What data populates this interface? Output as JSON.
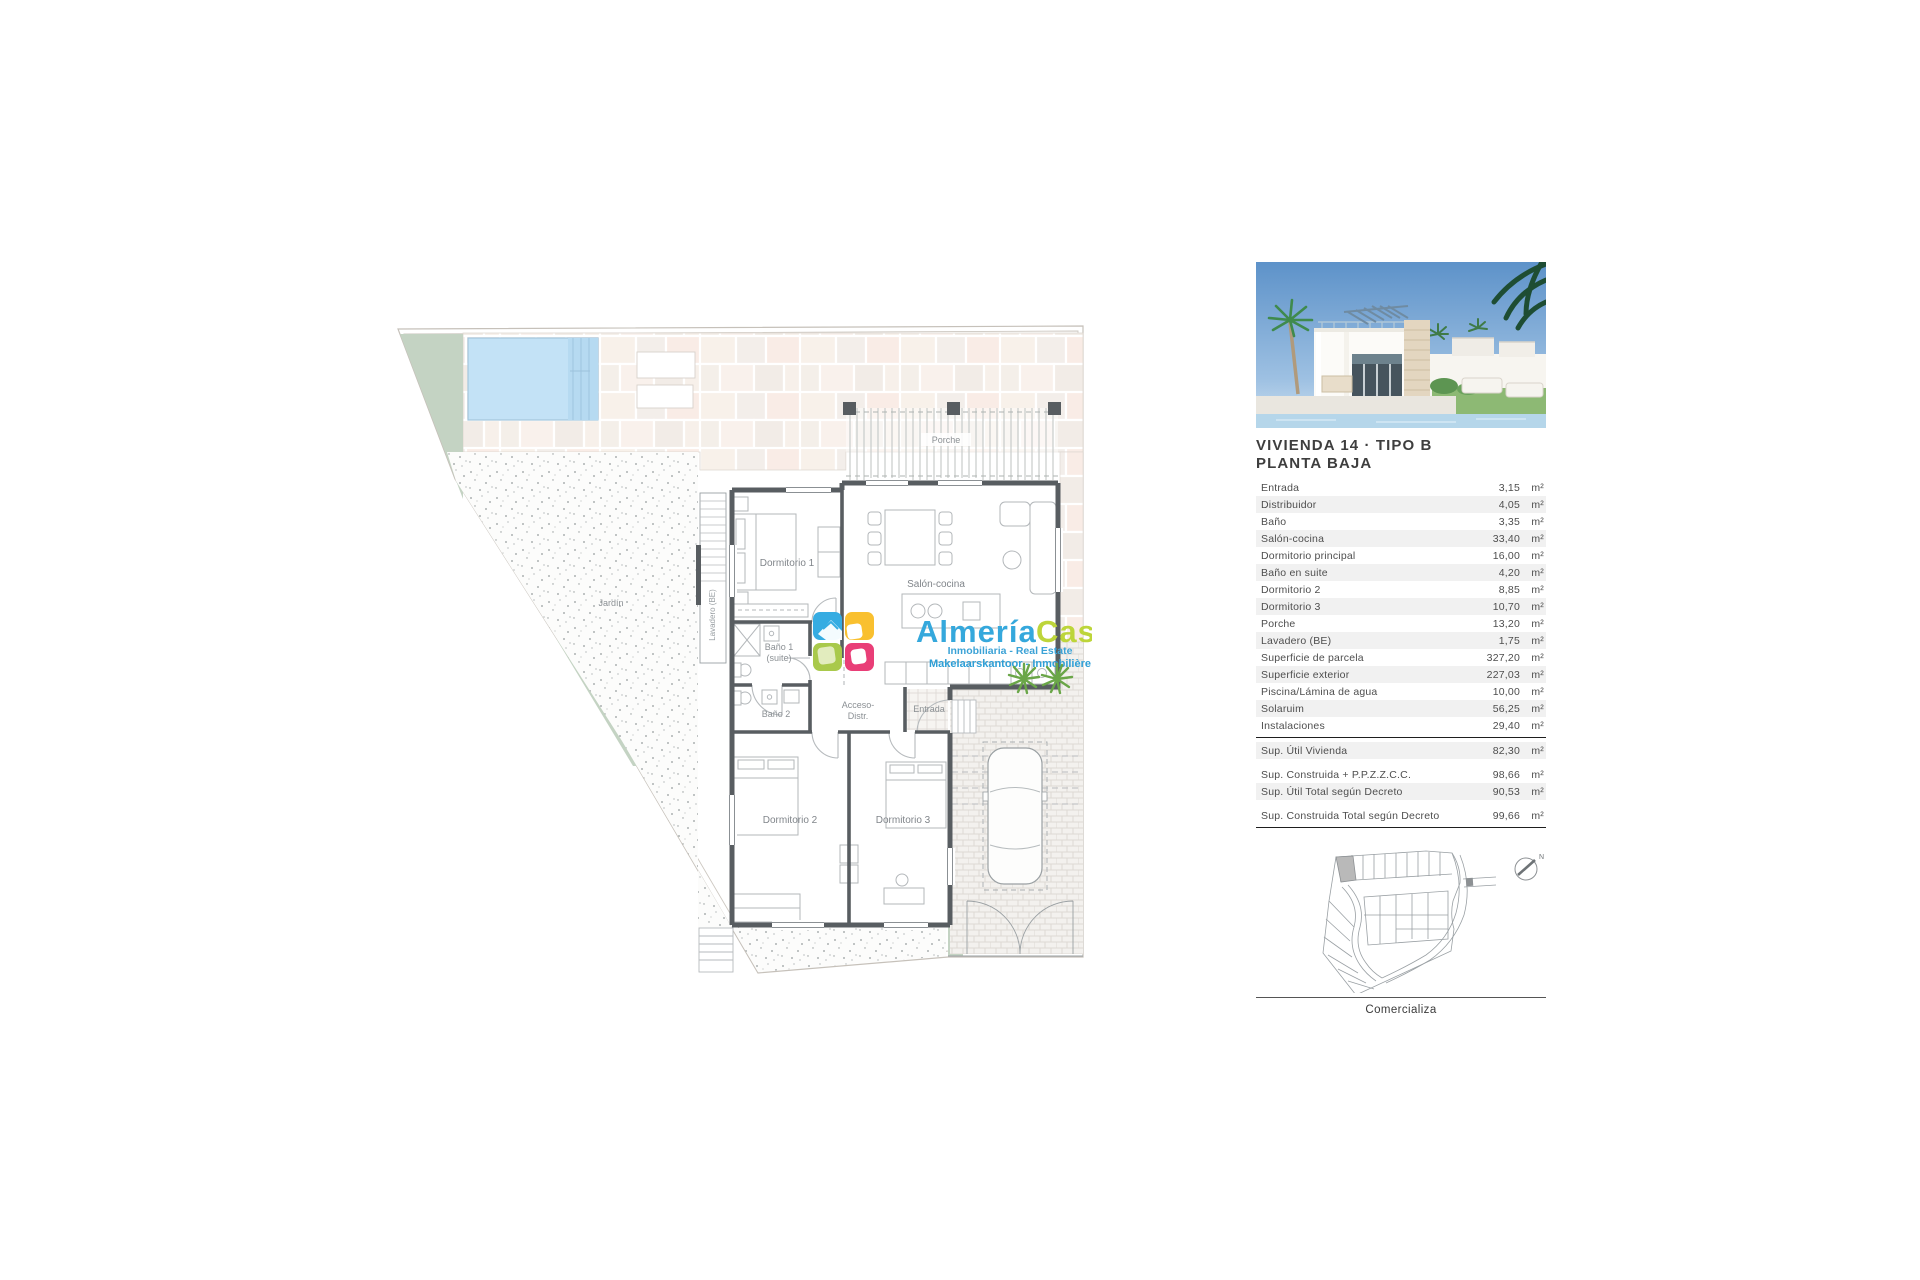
{
  "plan": {
    "labels": {
      "porche": "Porche",
      "jardin": "Jardín",
      "lavadero": "Lavadero (BE)",
      "dormitorio1": "Dormitorio 1",
      "salon": "Salón-cocina",
      "bano1_l1": "Baño 1",
      "bano1_l2": "(suite)",
      "bano2": "Baño 2",
      "acceso_l1": "Acceso-",
      "acceso_l2": "Distr.",
      "entrada": "Entrada",
      "dormitorio2": "Dormitorio 2",
      "dormitorio3": "Dormitorio 3"
    },
    "colors": {
      "wall": "#585d61",
      "garden_green": "#c4d3c3",
      "pool_blue": "#c3e2f6",
      "tile_cream": "#f7f0ea"
    }
  },
  "logo": {
    "brand_1": "Almería",
    "brand_2": "Casas",
    "tagline_1": "Inmobiliaria - Real Estate",
    "tagline_2": "Makelaarskantoor - Inmobilière",
    "colors": {
      "brand_blue": "#35a8dc",
      "brand_green": "#bdd53a",
      "icon_blue": "#36ace2",
      "icon_yellow": "#f9c02f",
      "icon_green": "#a9c94b",
      "icon_pink": "#e93e77"
    }
  },
  "panel": {
    "title_line1": "VIVIENDA 14 · TIPO B",
    "title_line2": "PLANTA BAJA",
    "measure_rows": [
      {
        "label": "Entrada",
        "value": "3,15",
        "unit": "m²"
      },
      {
        "label": "Distribuidor",
        "value": "4,05",
        "unit": "m²"
      },
      {
        "label": "Baño",
        "value": "3,35",
        "unit": "m²"
      },
      {
        "label": "Salón-cocina",
        "value": "33,40",
        "unit": "m²"
      },
      {
        "label": "Dormitorio principal",
        "value": "16,00",
        "unit": "m²"
      },
      {
        "label": "Baño en suite",
        "value": "4,20",
        "unit": "m²"
      },
      {
        "label": "Dormitorio 2",
        "value": "8,85",
        "unit": "m²"
      },
      {
        "label": "Dormitorio 3",
        "value": "10,70",
        "unit": "m²"
      },
      {
        "label": "Porche",
        "value": "13,20",
        "unit": "m²"
      },
      {
        "label": "Lavadero (BE)",
        "value": "1,75",
        "unit": "m²"
      },
      {
        "label": "Superficie de parcela",
        "value": "327,20",
        "unit": "m²"
      },
      {
        "label": "Superficie exterior",
        "value": "227,03",
        "unit": "m²"
      },
      {
        "label": "Piscina/Lámina de agua",
        "value": "10,00",
        "unit": "m²"
      },
      {
        "label": "Solaruim",
        "value": "56,25",
        "unit": "m²"
      },
      {
        "label": "Instalaciones",
        "value": "29,40",
        "unit": "m²"
      }
    ],
    "summary_a": {
      "label": "Sup. Útil Vivienda",
      "value": "82,30",
      "unit": "m²"
    },
    "summary_b1": {
      "label": "Sup. Construida + P.P.Z.Z.C.C.",
      "value": "98,66",
      "unit": "m²"
    },
    "summary_b2": {
      "label": "Sup. Útil Total según Decreto",
      "value": "90,53",
      "unit": "m²"
    },
    "summary_c": {
      "label": "Sup. Construida Total según Decreto",
      "value": "99,66",
      "unit": "m²"
    },
    "comercializa": "Comercializa",
    "north": "N"
  }
}
